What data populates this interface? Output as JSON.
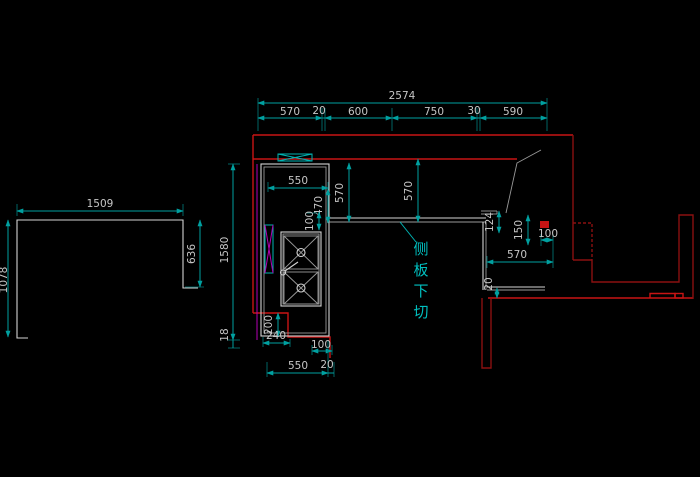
{
  "drawing": {
    "note_side_panel": {
      "label": "侧板下切",
      "chars": [
        "侧",
        "板",
        "下",
        "切"
      ]
    },
    "left_shape_dims": {
      "width": "1509",
      "height_left": "1078",
      "height_right": "636"
    },
    "top_dims": {
      "total": "2574",
      "segments": [
        "570",
        "20",
        "600",
        "750",
        "30",
        "590"
      ]
    },
    "left_dims": {
      "overall_height": "1580",
      "bottom_offset": "18"
    },
    "cabinet_dims": {
      "inner_width": "550",
      "inner_height": "470",
      "depth_left": "570",
      "depth_mid": "570",
      "corner_offset": "100",
      "notch_height": "200",
      "notch_width": "240",
      "notch_step": "100",
      "front_width": "550",
      "front_gap": "20"
    },
    "right_dims": {
      "panel_gap": "124",
      "cut_depth": "150",
      "cut_width": "100",
      "section_width": "570",
      "overhang": "20"
    }
  }
}
